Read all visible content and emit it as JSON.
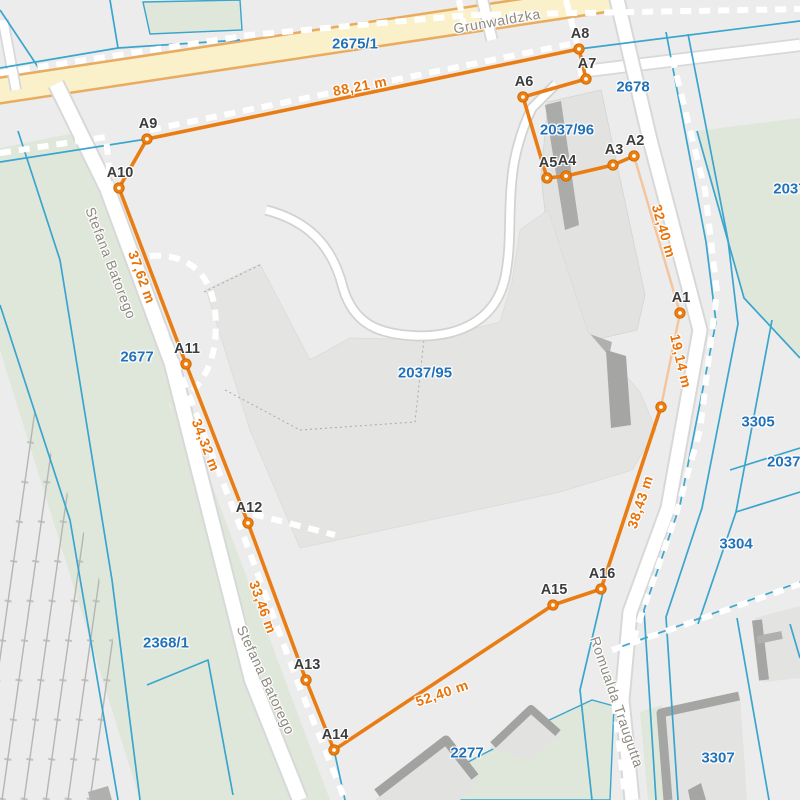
{
  "map": {
    "colors": {
      "background": "#ebeceb",
      "measure_line": "#ea7c14",
      "measure_line_light": "#f5c49b",
      "measure_point_fill": "#f07d0e",
      "measure_point_stroke": "#c96a06",
      "boundary_under": "#6a9a8f",
      "distance_text": "#e8730a",
      "parcel_text": "#2272b9",
      "street_text": "#8d8880",
      "point_text": "#3c3c3c",
      "cadastral_blue": "#3aa5cd",
      "highlight_road": "#faf1ca"
    },
    "points": [
      {
        "id": "A1",
        "x": 680,
        "y": 313
      },
      {
        "id": "A2",
        "x": 634,
        "y": 156
      },
      {
        "id": "A3",
        "x": 613,
        "y": 165
      },
      {
        "id": "A4",
        "x": 566,
        "y": 176
      },
      {
        "id": "A5",
        "x": 547,
        "y": 178
      },
      {
        "id": "A6",
        "x": 523,
        "y": 97
      },
      {
        "id": "A7",
        "x": 586,
        "y": 79
      },
      {
        "id": "A8",
        "x": 579,
        "y": 49
      },
      {
        "id": "A9",
        "x": 147,
        "y": 139
      },
      {
        "id": "A10",
        "x": 119,
        "y": 188
      },
      {
        "id": "A11",
        "x": 186,
        "y": 364
      },
      {
        "id": "A12",
        "x": 248,
        "y": 523
      },
      {
        "id": "A13",
        "x": 306,
        "y": 680
      },
      {
        "id": "A14",
        "x": 334,
        "y": 750
      },
      {
        "id": "A15",
        "x": 553,
        "y": 605
      },
      {
        "id": "A16",
        "x": 601,
        "y": 589
      }
    ],
    "vertices": [
      {
        "id": "V1",
        "x": 661,
        "y": 407
      }
    ],
    "polyline": {
      "order": [
        "A9",
        "A8",
        "A7",
        "A6",
        "A5",
        "A4",
        "A3",
        "A2",
        "A1",
        "V1",
        "A16",
        "A15",
        "A14",
        "A13",
        "A12",
        "A11",
        "A10",
        "A9"
      ],
      "light_segments": [
        [
          "A2",
          "A1"
        ],
        [
          "A1",
          "V1"
        ]
      ]
    },
    "measurements": [
      {
        "text": "88,21 m",
        "x": 360,
        "y": 86,
        "angle": -11
      },
      {
        "text": "32,40 m",
        "x": 664,
        "y": 231,
        "angle": 74
      },
      {
        "text": "19,14 m",
        "x": 681,
        "y": 361,
        "angle": 77
      },
      {
        "text": "38,43 m",
        "x": 640,
        "y": 502,
        "angle": -72
      },
      {
        "text": "52,40 m",
        "x": 442,
        "y": 693,
        "angle": -19
      },
      {
        "text": "33,46 m",
        "x": 263,
        "y": 607,
        "angle": 70
      },
      {
        "text": "34,32 m",
        "x": 206,
        "y": 445,
        "angle": 69
      },
      {
        "text": "37,62 m",
        "x": 142,
        "y": 277,
        "angle": 70
      }
    ],
    "parcels": [
      {
        "number": "2675/1",
        "x": 355,
        "y": 44
      },
      {
        "number": "2678",
        "x": 633,
        "y": 87
      },
      {
        "number": "2037/96",
        "x": 567,
        "y": 130
      },
      {
        "number": "2037/",
        "x": 792,
        "y": 189
      },
      {
        "number": "2037/95",
        "x": 425,
        "y": 373
      },
      {
        "number": "2677",
        "x": 137,
        "y": 357
      },
      {
        "number": "3305",
        "x": 758,
        "y": 422
      },
      {
        "number": "2037/1",
        "x": 790,
        "y": 462
      },
      {
        "number": "3304",
        "x": 736,
        "y": 544
      },
      {
        "number": "2368/1",
        "x": 166,
        "y": 643
      },
      {
        "number": "2277",
        "x": 467,
        "y": 753
      },
      {
        "number": "3307",
        "x": 718,
        "y": 758
      }
    ],
    "streets": [
      {
        "name": "Grunwaldzka",
        "x": 497,
        "y": 21,
        "angle": -10
      },
      {
        "name": "Stefana Batorego",
        "x": 111,
        "y": 263,
        "angle": 69
      },
      {
        "name": "Stefana Batorego",
        "x": 266,
        "y": 680,
        "angle": 65
      },
      {
        "name": "Romualda Traugutta",
        "x": 617,
        "y": 702,
        "angle": 71
      }
    ]
  }
}
